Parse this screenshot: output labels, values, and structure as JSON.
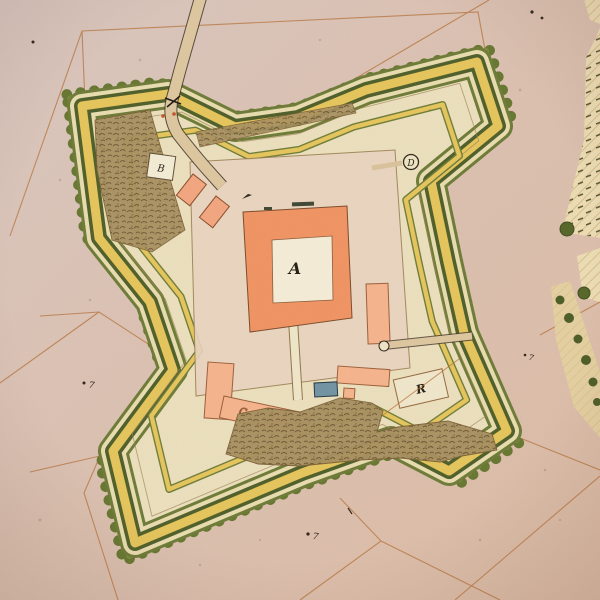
{
  "map": {
    "description": "Hand-drawn colored manuscript plan of a four-bastioned star fort on parchment",
    "annotations": {
      "citadel": {
        "label": "A"
      },
      "guardhouse": {
        "label": "B"
      },
      "south_barracks": {
        "label": "C"
      },
      "watch_tower": {
        "label": "D"
      },
      "outer_plot": {
        "label": "R"
      }
    },
    "field_marks": {
      "surveyor_mark": "7"
    },
    "colors": {
      "parchment": "#dbc2b5",
      "fort_ground": "#ebdfbc",
      "rampart_yellow": "#e5c45a",
      "rampart_green": "#6d7a36",
      "glacis_dark_green": "#4e5e28",
      "bushes": "#66762f",
      "buildings_salmon": "#f5b38b",
      "citadel_orange": "#f09362",
      "cistern_blue": "#7292a2",
      "earthwork_brown": "#a78f5f",
      "boundary_sepia": "#b5713a"
    }
  }
}
